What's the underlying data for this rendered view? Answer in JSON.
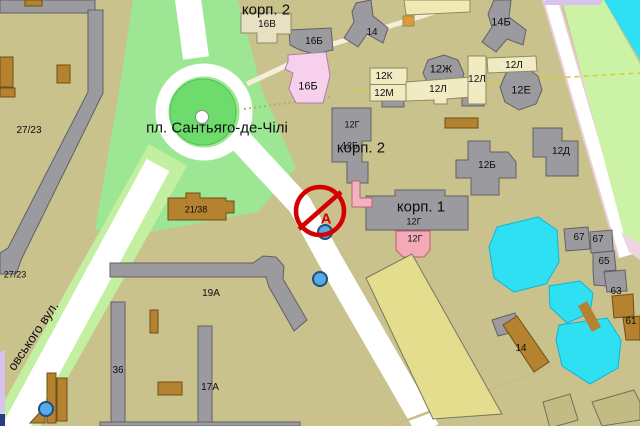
{
  "map": {
    "sign": {
      "letter": "А"
    },
    "labels": [
      {
        "text": "корп. 2",
        "x": 266,
        "y": 10,
        "size": 15
      },
      {
        "text": "16В",
        "x": 267,
        "y": 25,
        "size": 10
      },
      {
        "text": "16Б",
        "x": 314,
        "y": 42,
        "size": 10
      },
      {
        "text": "16Б",
        "x": 308,
        "y": 87,
        "size": 11
      },
      {
        "text": "14",
        "x": 372,
        "y": 33,
        "size": 10
      },
      {
        "text": "14Б",
        "x": 501,
        "y": 23,
        "size": 11
      },
      {
        "text": "12Ж",
        "x": 441,
        "y": 70,
        "size": 11
      },
      {
        "text": "12К",
        "x": 384,
        "y": 77,
        "size": 10
      },
      {
        "text": "12М",
        "x": 384,
        "y": 94,
        "size": 10
      },
      {
        "text": "12Л",
        "x": 438,
        "y": 90,
        "size": 10
      },
      {
        "text": "12Л",
        "x": 477,
        "y": 80,
        "size": 10
      },
      {
        "text": "12Л",
        "x": 514,
        "y": 66,
        "size": 10
      },
      {
        "text": "12Е",
        "x": 521,
        "y": 91,
        "size": 11
      },
      {
        "text": "12Г",
        "x": 352,
        "y": 125,
        "size": 9
      },
      {
        "text": "12Б",
        "x": 350,
        "y": 146,
        "size": 9
      },
      {
        "text": "корп. 2",
        "x": 361,
        "y": 148,
        "size": 15
      },
      {
        "text": "12Д",
        "x": 561,
        "y": 152,
        "size": 10
      },
      {
        "text": "12Б",
        "x": 487,
        "y": 166,
        "size": 10
      },
      {
        "text": "корп. 1",
        "x": 421,
        "y": 207,
        "size": 15
      },
      {
        "text": "12Г",
        "x": 414,
        "y": 222,
        "size": 9
      },
      {
        "text": "12Г",
        "x": 415,
        "y": 239,
        "size": 9
      },
      {
        "text": "21/38",
        "x": 196,
        "y": 210,
        "size": 9
      },
      {
        "text": "19А",
        "x": 211,
        "y": 294,
        "size": 10
      },
      {
        "text": "36",
        "x": 118,
        "y": 371,
        "size": 10
      },
      {
        "text": "17А",
        "x": 210,
        "y": 388,
        "size": 10
      },
      {
        "text": "27/23",
        "x": 29,
        "y": 131,
        "size": 10
      },
      {
        "text": "27/23",
        "x": 15,
        "y": 275,
        "size": 9
      },
      {
        "text": "67",
        "x": 579,
        "y": 238,
        "size": 10
      },
      {
        "text": "67",
        "x": 598,
        "y": 240,
        "size": 10
      },
      {
        "text": "65",
        "x": 604,
        "y": 262,
        "size": 10
      },
      {
        "text": "63",
        "x": 616,
        "y": 292,
        "size": 10
      },
      {
        "text": "61",
        "x": 631,
        "y": 322,
        "size": 10
      },
      {
        "text": "14",
        "x": 521,
        "y": 349,
        "size": 10
      },
      {
        "text": "пл.  Сантьяго-де-Чілі",
        "x": 217,
        "y": 128,
        "size": 15
      },
      {
        "text": "овського вул.",
        "x": 33,
        "y": 336,
        "size": 13,
        "rot": -56
      }
    ],
    "markers": [
      {
        "kind": "white-dot",
        "x": 202,
        "y": 117,
        "r": 7
      },
      {
        "kind": "blue-dot",
        "x": 325,
        "y": 232,
        "r": 8
      },
      {
        "kind": "blue-dot",
        "x": 320,
        "y": 279,
        "r": 8
      },
      {
        "kind": "blue-dot",
        "x": 46,
        "y": 409,
        "r": 8
      },
      {
        "kind": "flag",
        "x": 0,
        "y": 414,
        "w": 5,
        "h": 12
      }
    ],
    "colors": {
      "land": "#c9c28d",
      "park_light": "#9de693",
      "park_dark": "#6edc6c",
      "park_dark_stroke": "#4fc04f",
      "verge": "#c3efa1",
      "greenery": "#ccf3a5",
      "water": "#2fdff2",
      "water_stroke": "#0cb6d6",
      "lavender": "#d8c3ee",
      "road_white": "#ffffff",
      "road_casing": "#e9cdd8",
      "pink_edge": "#eed3e2",
      "building_gray": "#9b9b9f",
      "building_gray_stroke": "#5f5f66",
      "building_brown": "#b5832f",
      "building_brown_stroke": "#6e4f16",
      "building_cream": "#f1ebc4",
      "building_cream_stroke": "#8f8a60",
      "building_beige": "#e7e0c2",
      "building_pink_light": "#f6d0ec",
      "building_pink_stroke": "#b87aa8",
      "building_pink": "#f4a9b6",
      "building_pink2_stroke": "#c06070",
      "building_pale": "#e5dd8e",
      "building_pale_stroke": "#77775f",
      "building_khaki": "#c3bb84",
      "building_khaki_stroke": "#70705a",
      "orange": "#e2992f",
      "sign_red": "#d50000",
      "marker_blue": "#57a9e8",
      "marker_blue_stroke": "#1b4f7e",
      "flag_navy": "#2b3a86",
      "dashed_yellow": "#d6cf35",
      "path_dot": "#b9a96a",
      "path_tan": "#cdbd85"
    }
  }
}
